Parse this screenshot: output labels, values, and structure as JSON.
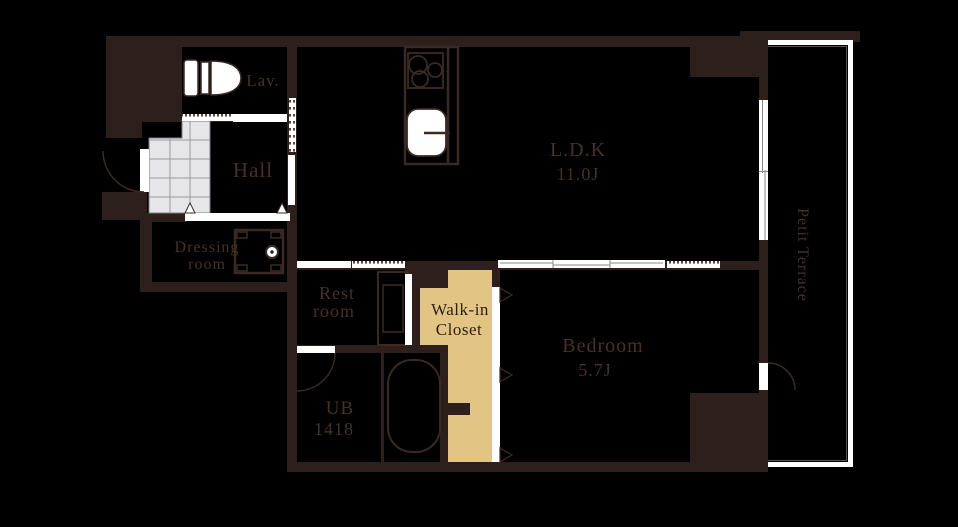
{
  "canvas": {
    "width": 958,
    "height": 527,
    "background": "#000000"
  },
  "palette": {
    "wall": "#2d201c",
    "outline": "#3b2a23",
    "room_text": "#463129",
    "closet_fill": "#e2c484",
    "closet_text": "#2f1e15",
    "tile_fill": "#e6e5e8",
    "tile_grid": "#9b9aa0",
    "door_white": "#ffffff",
    "track_gray": "#8a8a8a"
  },
  "rooms": {
    "lav": {
      "label": "Lav."
    },
    "hall": {
      "label": "Hall"
    },
    "dressing_room": {
      "label_line1": "Dressing",
      "label_line2": "room"
    },
    "rest_room": {
      "label_line1": "Rest",
      "label_line2": "room"
    },
    "walk_in_closet": {
      "label_line1": "Walk-in",
      "label_line2": "Closet"
    },
    "unit_bath": {
      "label_line1": "UB",
      "label_line2": "1418"
    },
    "ldk": {
      "name": "L.D.K",
      "size": "11.0J"
    },
    "bedroom": {
      "name": "Bedroom",
      "size": "5.7J"
    },
    "terrace": {
      "label": "Petit Terrace"
    }
  },
  "fixtures": [
    "toilet",
    "kitchen-counter",
    "stove-burners",
    "kitchen-sink",
    "washing-machine-pan",
    "vanity",
    "bathtub",
    "genkan-tile",
    "entry-door",
    "ub-door",
    "terrace-door",
    "sliding-doors",
    "accordion-tracks",
    "ldk-window",
    "closet-folding-door",
    "terrace-railing"
  ]
}
